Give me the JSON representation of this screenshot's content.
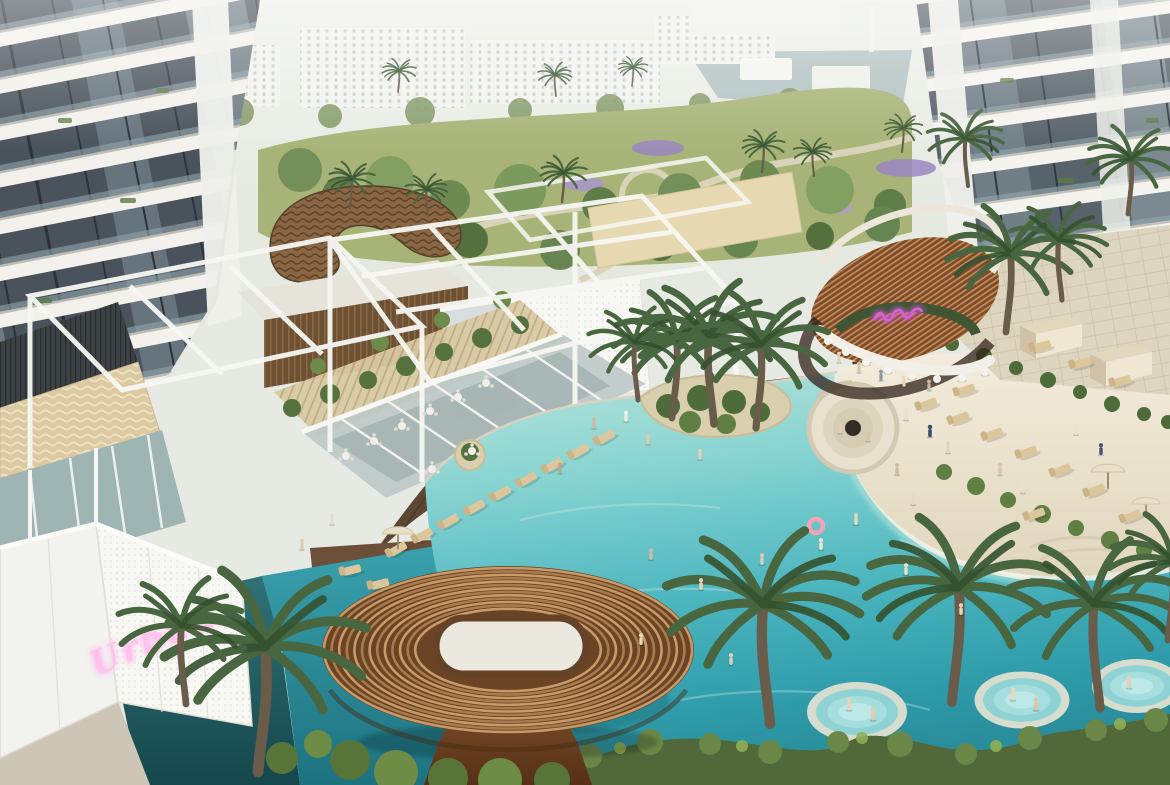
{
  "meta": {
    "image_type": "architectural rendering",
    "scene": "aerial view of a resort-style residential amenity podium with lagoon pool, beach entry, swim-up bar, sun decks and two high-rise towers",
    "time_of_day": "hazy daylight"
  },
  "signs": {
    "wall_neon": {
      "text": "Urban",
      "style": "cursive neon script, partially hidden by palm",
      "color": "#ffb9ec"
    },
    "bar_neon": {
      "text": "",
      "style": "small illegible cursive neon script above bar",
      "color": "#d95fd8"
    }
  },
  "palette": {
    "pool_turquoise": "#4cb6bf",
    "pool_deep": "#2a8d9b",
    "shadow_water": "#1f5b60",
    "beach_sand": "#ece2cd",
    "deck_wood": "#5c4733",
    "copper_slats": "#8a5530",
    "copper_highlight": "#c08a58",
    "white_structure": "#f4f4ef",
    "tower_glass": "#4a535c",
    "lawn": "#a8b477",
    "palm_green": "#46633b",
    "hedge": "#50683a",
    "stone_beige": "#dcc9a2"
  },
  "regions": {
    "background": "hazy lake, low white apartment blocks and landscaped park with winding paths and purple flower beds",
    "left_tower": "residential tower with diagonal white balcony bands and glass",
    "right_tower": "residential tower with white balcony bands and glass",
    "clubhouse": "timber-slat clubhouse with gravel roof and wavy sculptural copper canopy",
    "restaurant": "glass pavilion with white pergola grid, terrace tables and pool deck loungers",
    "pool": "organic lagoon pool with planted palm island, beach entry and in-water spa pools",
    "bar": "pool bar with curved copper-slat roof, white counter, stools and neon sign",
    "sunken_lounge": "circular sunken fire-pit lounge beside the beach",
    "foreground_pavilion": "large oval copper-slat canopy with white pebble oculus on a sculpted base",
    "perimeter_wall": "white perforated wall with pink neon script sign"
  },
  "sprites": {
    "palms": [
      {
        "x": 672,
        "y": 418,
        "s": 1.5
      },
      {
        "x": 714,
        "y": 424,
        "s": 1.7,
        "f": true
      },
      {
        "x": 756,
        "y": 428,
        "s": 1.6
      },
      {
        "x": 638,
        "y": 400,
        "s": 1.1,
        "f": true
      },
      {
        "x": 1006,
        "y": 332,
        "s": 1.5
      },
      {
        "x": 1062,
        "y": 300,
        "s": 1.15,
        "f": true
      },
      {
        "x": 1128,
        "y": 214,
        "s": 1.05
      },
      {
        "x": 968,
        "y": 186,
        "s": 0.9,
        "f": true
      },
      {
        "x": 258,
        "y": 772,
        "s": 2.4
      },
      {
        "x": 186,
        "y": 704,
        "s": 1.5,
        "f": true
      },
      {
        "x": 770,
        "y": 724,
        "s": 2.3,
        "f": true
      },
      {
        "x": 952,
        "y": 702,
        "s": 2.2
      },
      {
        "x": 1100,
        "y": 708,
        "s": 2.0,
        "f": true
      },
      {
        "x": 1168,
        "y": 640,
        "s": 1.5
      },
      {
        "x": 350,
        "y": 208,
        "s": 0.55
      },
      {
        "x": 428,
        "y": 216,
        "s": 0.5,
        "f": true
      },
      {
        "x": 562,
        "y": 202,
        "s": 0.55
      },
      {
        "x": 762,
        "y": 172,
        "s": 0.5
      },
      {
        "x": 814,
        "y": 176,
        "s": 0.45,
        "f": true
      },
      {
        "x": 902,
        "y": 152,
        "s": 0.45
      },
      {
        "x": 398,
        "y": 92,
        "s": 0.4
      },
      {
        "x": 556,
        "y": 96,
        "s": 0.4,
        "f": true
      },
      {
        "x": 632,
        "y": 86,
        "s": 0.35
      }
    ],
    "loungers": [
      {
        "x": 398,
        "y": 549,
        "r": -30
      },
      {
        "x": 424,
        "y": 535,
        "r": -30
      },
      {
        "x": 450,
        "y": 521,
        "r": -30
      },
      {
        "x": 476,
        "y": 507,
        "r": -30
      },
      {
        "x": 502,
        "y": 493,
        "r": -30
      },
      {
        "x": 528,
        "y": 479,
        "r": -30
      },
      {
        "x": 554,
        "y": 465,
        "r": -30
      },
      {
        "x": 580,
        "y": 451,
        "r": -30
      },
      {
        "x": 606,
        "y": 437,
        "r": -30
      },
      {
        "x": 352,
        "y": 570,
        "r": -14
      },
      {
        "x": 380,
        "y": 584,
        "r": -14
      },
      {
        "x": 928,
        "y": 404,
        "r": -20
      },
      {
        "x": 960,
        "y": 418,
        "r": -20
      },
      {
        "x": 994,
        "y": 434,
        "r": -20
      },
      {
        "x": 1028,
        "y": 452,
        "r": -20
      },
      {
        "x": 1062,
        "y": 470,
        "r": -22
      },
      {
        "x": 1096,
        "y": 490,
        "r": -22
      },
      {
        "x": 1036,
        "y": 514,
        "r": -20
      },
      {
        "x": 1132,
        "y": 516,
        "r": -22
      },
      {
        "x": 966,
        "y": 390,
        "r": -18
      },
      {
        "x": 1042,
        "y": 346,
        "r": -15
      },
      {
        "x": 1082,
        "y": 363,
        "r": -15
      },
      {
        "x": 1122,
        "y": 381,
        "r": -15
      }
    ],
    "people": [
      {
        "x": 594,
        "y": 425,
        "c": "#cbb9a2",
        "s": 0.85
      },
      {
        "x": 626,
        "y": 418,
        "c": "#f2efe6",
        "s": 0.85
      },
      {
        "x": 648,
        "y": 441,
        "c": "#dcc9ae",
        "s": 0.85
      },
      {
        "x": 700,
        "y": 456,
        "c": "#e2cfb6",
        "s": 0.85
      },
      {
        "x": 560,
        "y": 470,
        "c": "#b9a88f",
        "s": 0.85
      },
      {
        "x": 906,
        "y": 416,
        "c": "#e9e1cf",
        "s": 0.95
      },
      {
        "x": 930,
        "y": 433,
        "c": "#3c4c6a",
        "s": 0.95
      },
      {
        "x": 948,
        "y": 449,
        "c": "#e4d4b9",
        "s": 0.95
      },
      {
        "x": 1000,
        "y": 471,
        "c": "#dbc8aa",
        "s": 0.95
      },
      {
        "x": 1023,
        "y": 489,
        "c": "#eadfca",
        "s": 0.95
      },
      {
        "x": 897,
        "y": 471,
        "c": "#cdbba2",
        "s": 0.9
      },
      {
        "x": 913,
        "y": 501,
        "c": "#e8dac2",
        "s": 0.9
      },
      {
        "x": 856,
        "y": 521,
        "c": "#ead8be",
        "s": 0.9
      },
      {
        "x": 821,
        "y": 546,
        "c": "#f1e3cd",
        "s": 0.9
      },
      {
        "x": 762,
        "y": 561,
        "c": "#decbb0",
        "s": 0.9
      },
      {
        "x": 701,
        "y": 586,
        "c": "#e6d4ba",
        "s": 0.9
      },
      {
        "x": 651,
        "y": 556,
        "c": "#cfbca2",
        "s": 0.9
      },
      {
        "x": 906,
        "y": 571,
        "c": "#ebdec6",
        "s": 0.9
      },
      {
        "x": 961,
        "y": 611,
        "c": "#e4d4ba",
        "s": 0.9
      },
      {
        "x": 641,
        "y": 641,
        "c": "#e8d6bc",
        "s": 0.9
      },
      {
        "x": 731,
        "y": 661,
        "c": "#e1cfb4",
        "s": 0.9
      },
      {
        "x": 839,
        "y": 359,
        "c": "#e5d2b6",
        "s": 0.85
      },
      {
        "x": 859,
        "y": 369,
        "c": "#dbc4a6",
        "s": 0.85
      },
      {
        "x": 881,
        "y": 377,
        "c": "#8a9aaa",
        "s": 0.85
      },
      {
        "x": 904,
        "y": 383,
        "c": "#e8d6ba",
        "s": 0.85
      },
      {
        "x": 929,
        "y": 387,
        "c": "#cdb69c",
        "s": 0.85
      },
      {
        "x": 840,
        "y": 430,
        "c": "#e2d0b6",
        "s": 0.8
      },
      {
        "x": 868,
        "y": 438,
        "c": "#d8c4a8",
        "s": 0.8
      },
      {
        "x": 332,
        "y": 521,
        "c": "#eaddc9",
        "s": 0.85
      },
      {
        "x": 302,
        "y": 546,
        "c": "#decdb2",
        "s": 0.85
      },
      {
        "x": 1076,
        "y": 431,
        "c": "#eae2d2",
        "s": 0.9
      },
      {
        "x": 1101,
        "y": 451,
        "c": "#46526c",
        "s": 0.9
      },
      {
        "x": 849,
        "y": 706,
        "c": "#e8d4b8",
        "s": 1.0
      },
      {
        "x": 873,
        "y": 716,
        "c": "#e1cbae",
        "s": 1.0
      },
      {
        "x": 1013,
        "y": 696,
        "c": "#ead8be",
        "s": 1.0
      },
      {
        "x": 1036,
        "y": 706,
        "c": "#dbc6aa",
        "s": 1.0
      },
      {
        "x": 1129,
        "y": 684,
        "c": "#e5d1b6",
        "s": 1.0
      }
    ],
    "tables": [
      {
        "x": 346,
        "y": 456
      },
      {
        "x": 374,
        "y": 441
      },
      {
        "x": 402,
        "y": 426
      },
      {
        "x": 430,
        "y": 411
      },
      {
        "x": 458,
        "y": 397
      },
      {
        "x": 486,
        "y": 383
      },
      {
        "x": 432,
        "y": 469
      },
      {
        "x": 472,
        "y": 451
      }
    ],
    "stools": [
      {
        "x": 828,
        "y": 341
      },
      {
        "x": 846,
        "y": 352
      },
      {
        "x": 866,
        "y": 362
      },
      {
        "x": 888,
        "y": 370
      },
      {
        "x": 912,
        "y": 376
      },
      {
        "x": 937,
        "y": 379
      },
      {
        "x": 962,
        "y": 378
      },
      {
        "x": 985,
        "y": 372
      }
    ],
    "spas": [
      {
        "x": 857,
        "y": 712,
        "s": 1
      },
      {
        "x": 1022,
        "y": 700,
        "s": 0.95
      },
      {
        "x": 1137,
        "y": 686,
        "s": 0.9
      }
    ],
    "umbrellas": [
      {
        "x": 398,
        "y": 534,
        "s": 1.1
      },
      {
        "x": 1108,
        "y": 472,
        "s": 1.2
      },
      {
        "x": 1146,
        "y": 504,
        "s": 1
      }
    ],
    "cabanas": [
      {
        "x": 1048,
        "y": 332,
        "s": 1
      },
      {
        "x": 1118,
        "y": 360,
        "s": 1
      }
    ]
  }
}
